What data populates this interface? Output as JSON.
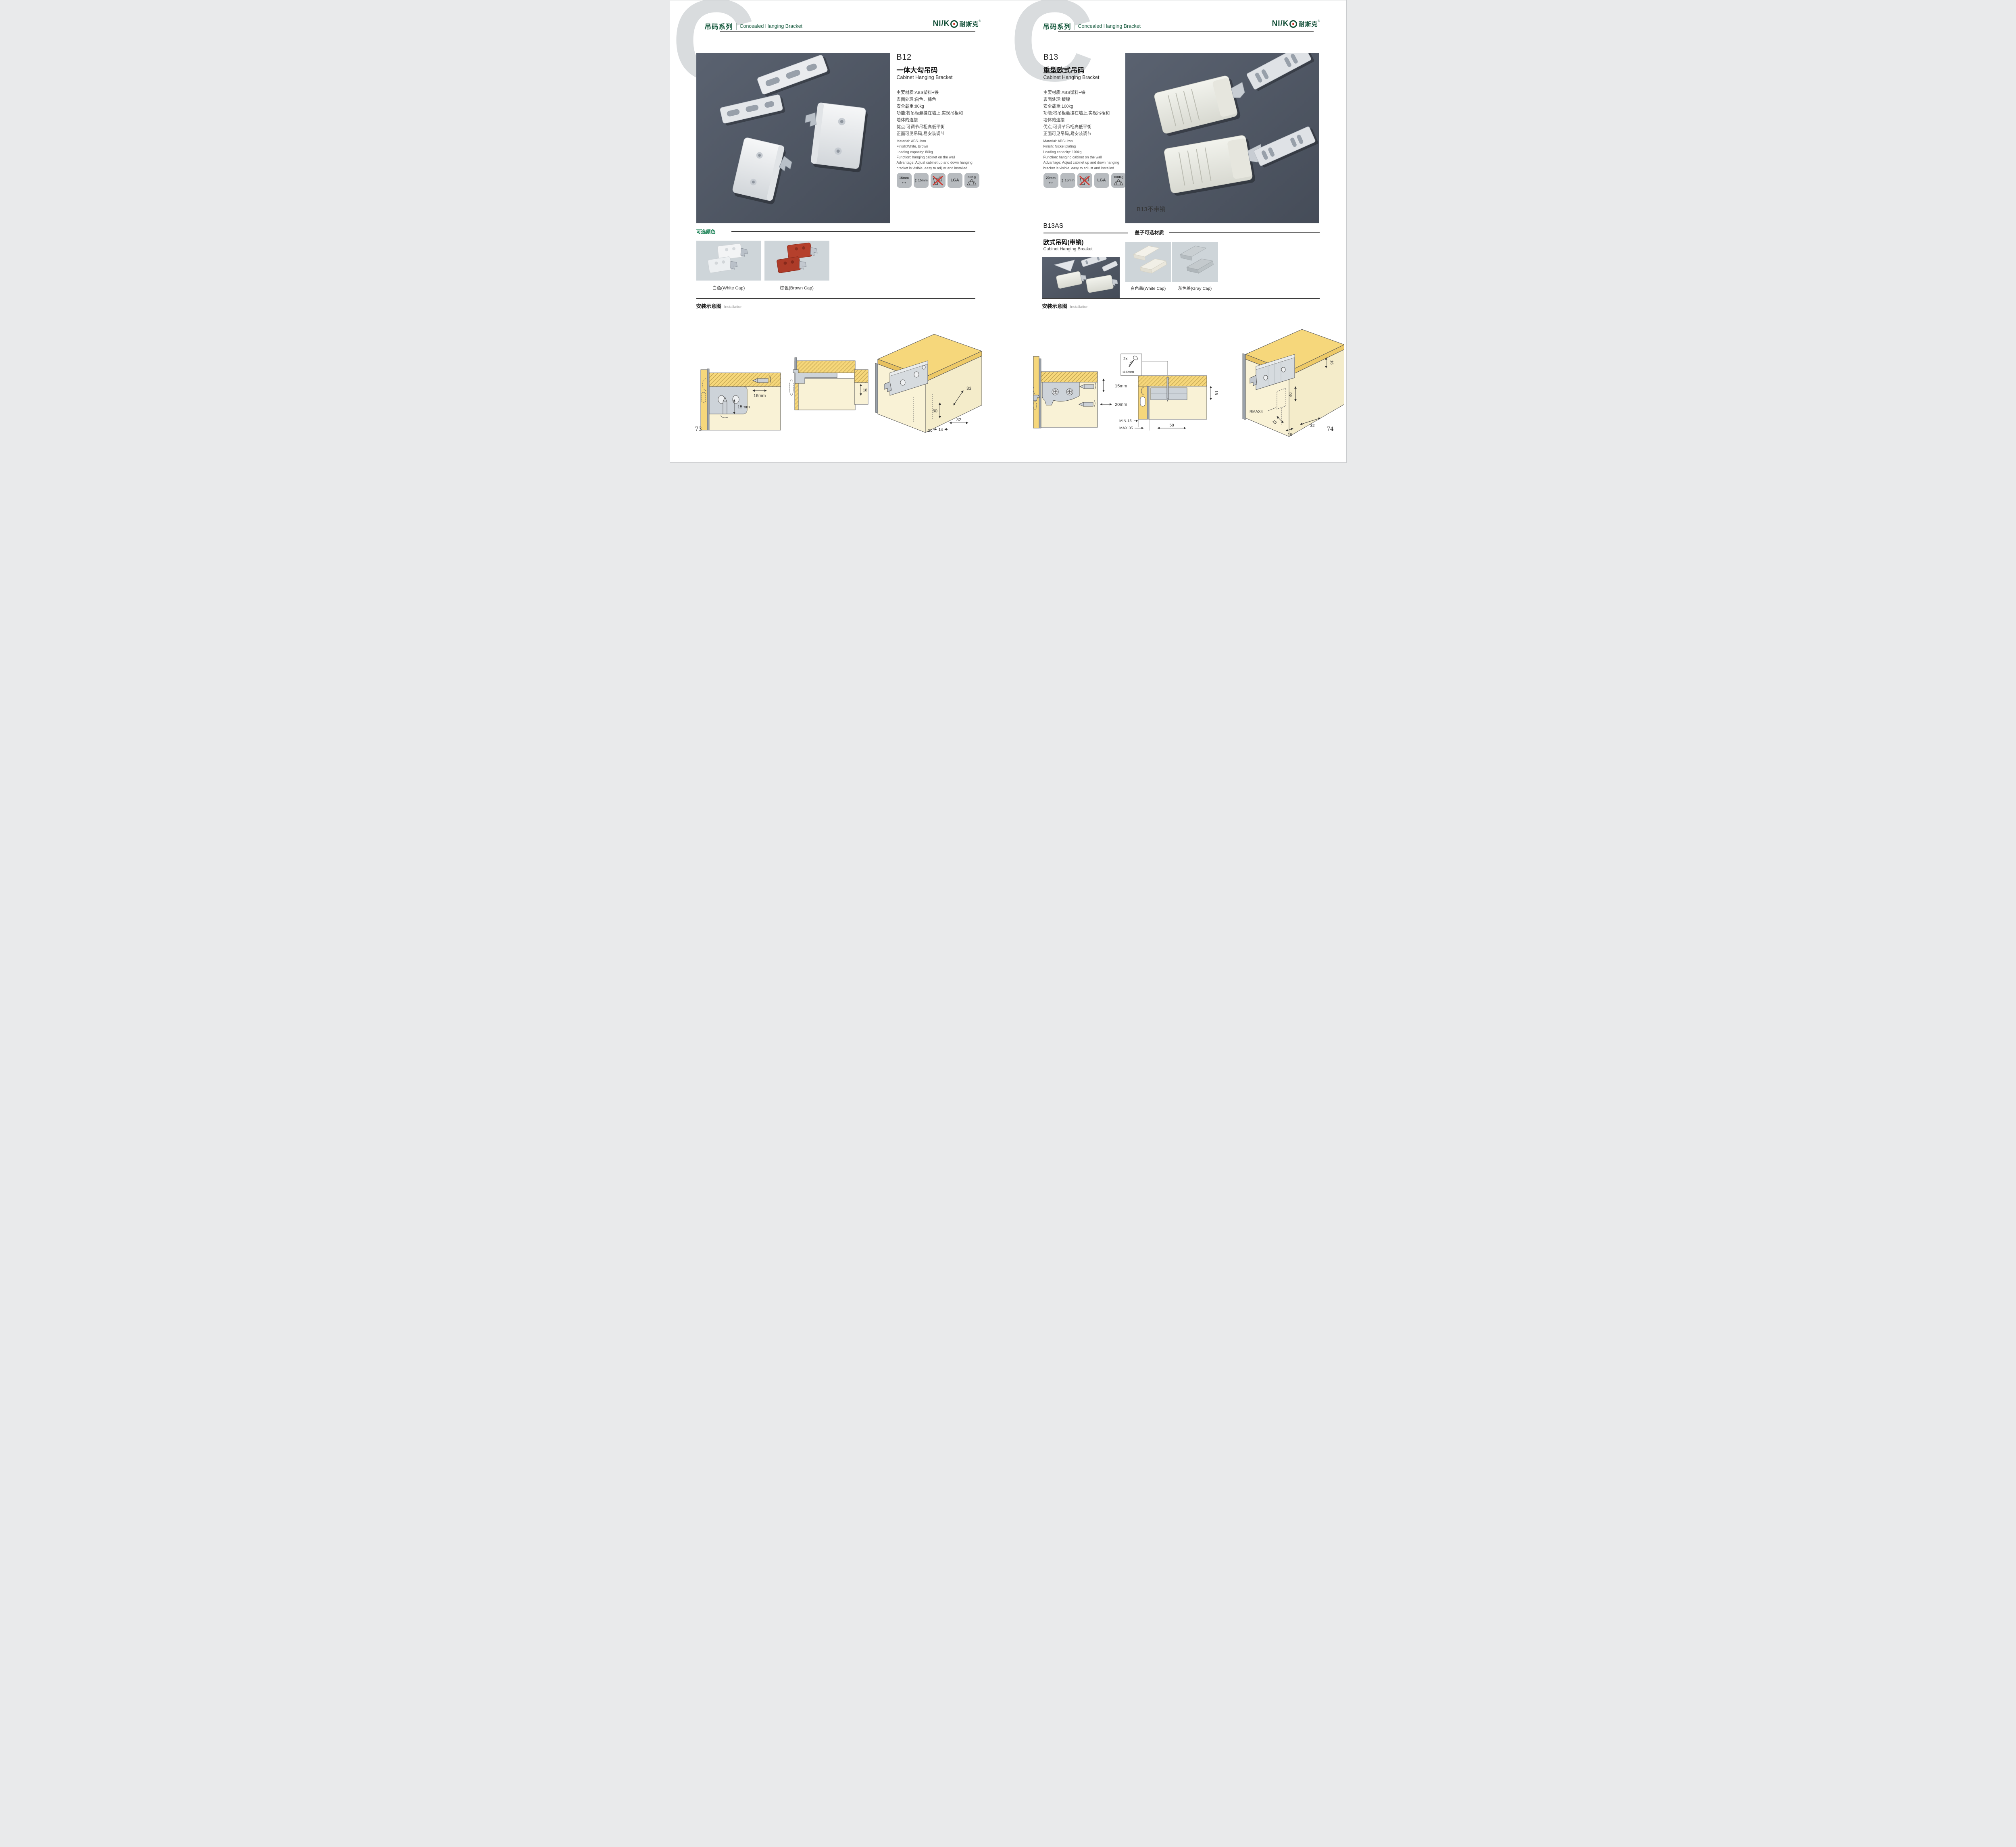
{
  "brand": {
    "logo_text": "NI/K",
    "logo_cn": "耐斯克",
    "reg": "®"
  },
  "header": {
    "watermark": "C",
    "series_cn": "吊码系列",
    "series_en": "Concealed Hanging Bracket"
  },
  "glyphs": {
    "harrow": "↔",
    "varrow": "↕"
  },
  "left_page": {
    "product": {
      "code": "B12",
      "name_cn": "一体大勾吊码",
      "name_en": "Cabinet Hanging Bracket",
      "specs_cn": [
        "主要材质:ABS塑料+铁",
        "表面处理:白色、棕色",
        "安全载重:80kg",
        "功能:将吊柜悬挂在墙上,实现吊柜和",
        "墙体的连接",
        "优点:可调节吊柜高低平衡",
        "正面可见吊码,易安装调节"
      ],
      "specs_en": [
        "Material: ABS+iron",
        "Finish:White, Brown",
        "Loading capacity: 80kg",
        "Function: hanging cabinet on the wall",
        "Advantage: Adjust cabinet up and down hanging",
        "bracket is visible, easy to adjust and installed"
      ],
      "icons": {
        "w": "16mm",
        "h": "15mm",
        "lga": "LGA",
        "load": "80Kg"
      }
    },
    "colors_section": {
      "title": "可选颜色",
      "white_label": "白色(White Cap)",
      "brown_label": "棕色(Brown Cap)"
    },
    "installation": {
      "title_cn": "安装示意图",
      "title_en": "Installation",
      "d1": {
        "dim_w": "16mm",
        "dim_h": "15mm"
      },
      "d3": {
        "inset": "18",
        "a": "33",
        "b": "30",
        "c": "32",
        "d": "20",
        "e": "14"
      }
    },
    "page_number": "73"
  },
  "right_page": {
    "product": {
      "code": "B13",
      "name_cn": "重型欧式吊码",
      "name_en": "Cabinet Hanging Bracket",
      "specs_cn": [
        "主要材质:ABS塑料+铁",
        "表面处理:镀镍",
        "安全载重:100kg",
        "功能:将吊柜悬挂在墙上,实现吊柜和",
        "墙体的连接",
        "优点:可调节吊柜高低平衡",
        "正面可见吊码,易安装调节"
      ],
      "specs_en": [
        "Material: ABS+iron",
        "Finish: Nickel plating",
        "Loading capacity: 100kg",
        "Function: hanging cabinet on the wall",
        "Advantage: Adjust cabinet up and down hanging",
        "bracket is visible, easy to adjust and installed"
      ],
      "icons": {
        "w": "20mm",
        "h": "15mm",
        "lga": "LGA",
        "load": "100Kg"
      },
      "image_caption": "B13不带销"
    },
    "sub_product": {
      "code": "B13AS",
      "name_cn": "欧式吊码(带销)",
      "name_en": "Cabinet Hanging Brcaket"
    },
    "caps_section": {
      "title": "盖子可选材质",
      "white_label": "白色盖(White Cap)",
      "gray_label": "灰色盖(Gray Cap)"
    },
    "installation": {
      "title_cn": "安装示意图",
      "title_en": "Installation",
      "screw_box": {
        "count": "2x",
        "dia": "Φ4mm"
      },
      "d1": {
        "dim_v": "15mm",
        "dim_h": "20mm"
      },
      "d2": {
        "right": "18",
        "min": "MIN.15",
        "max": "MAX.35",
        "width": "58"
      },
      "d3": {
        "a": "16",
        "b": "40",
        "r": "RMAX4",
        "c": "19",
        "d": "18",
        "e": "32"
      }
    },
    "page_number": "74"
  }
}
